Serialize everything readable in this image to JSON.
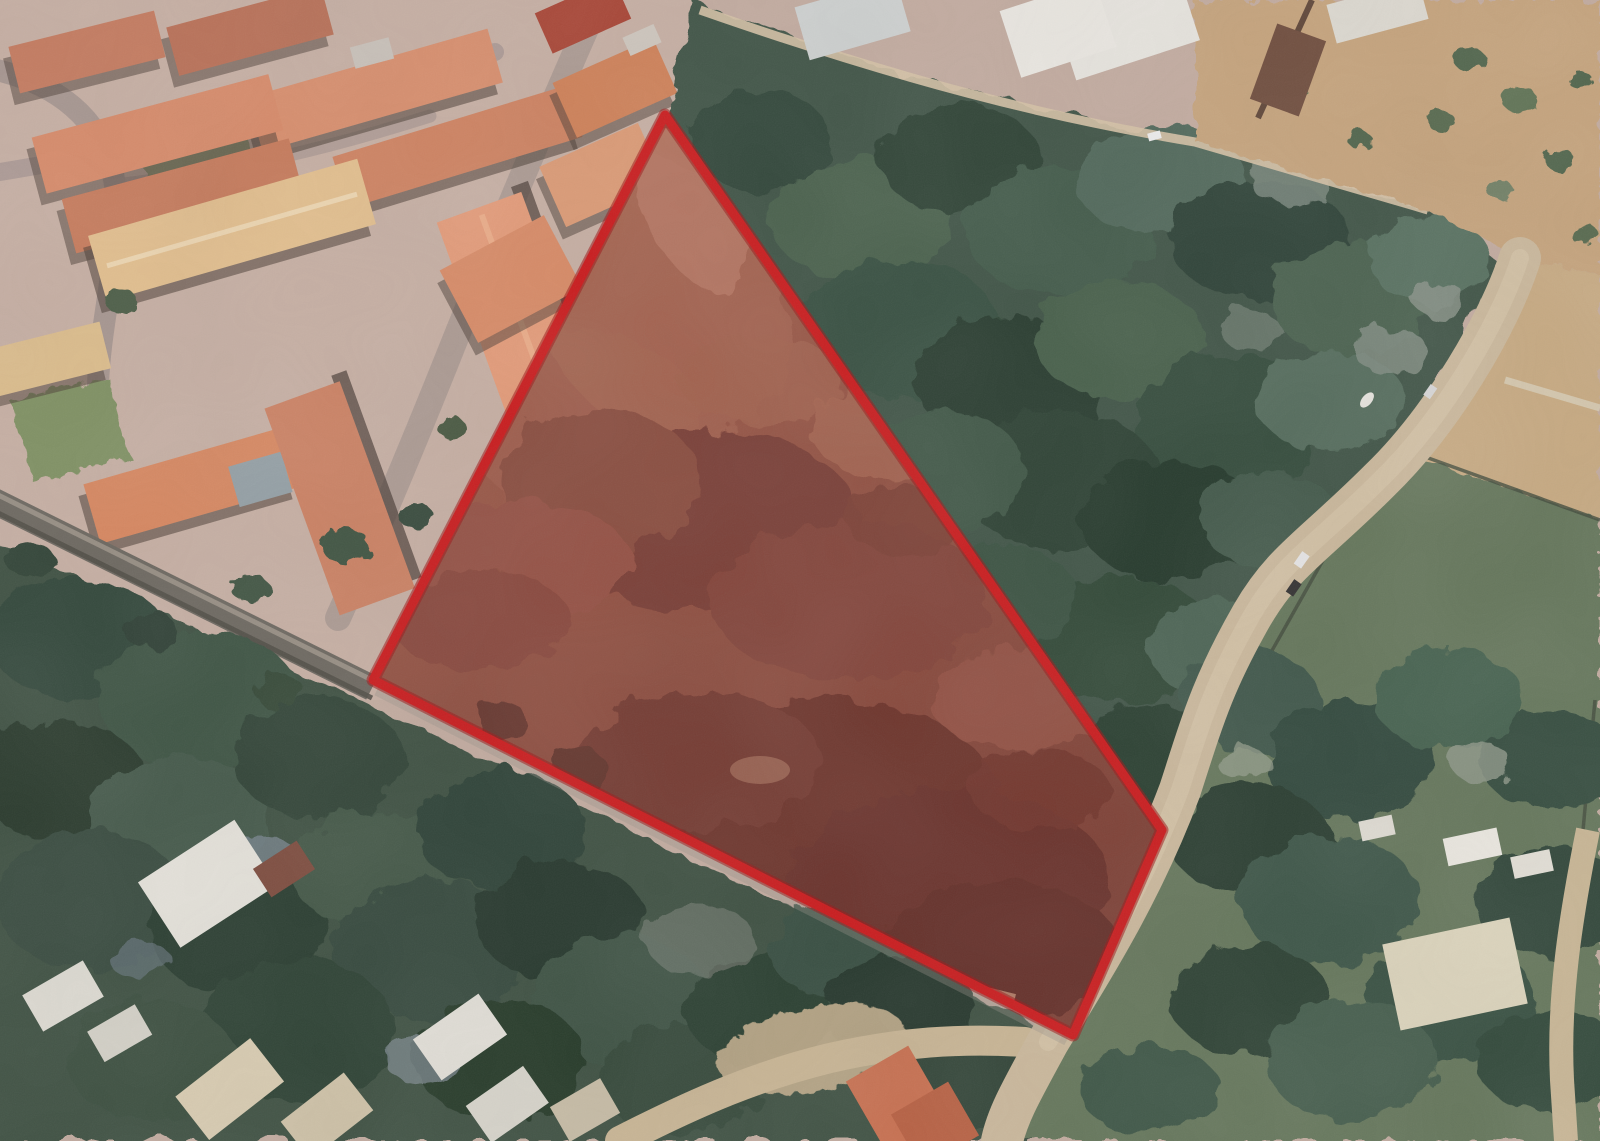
{
  "meta": {
    "view": "satellite-aerial-imagery",
    "visible_text": "none",
    "description": "Aerial photo with a red-outlined quadrilateral land parcel of cleared reddish earth; terracotta-roof housing blocks top-left, dense dark woodland top-right, tree-covered homes bottom-left, tan roads and green fields right and bottom"
  },
  "overlay": {
    "shape": "polygon",
    "purpose": "land-parcel-boundary",
    "outline_color": "#cb1719",
    "outline_inner_color": "#e02722",
    "outline_width_px": 9,
    "fill_color": "#c81e1e",
    "fill_opacity": 0.16,
    "vertices_px": [
      [
        665,
        115
      ],
      [
        1162,
        830
      ],
      [
        1073,
        1035
      ],
      [
        373,
        680
      ]
    ]
  },
  "scene": {
    "palette": {
      "ground": "#c3aca0",
      "ground_light": "#d2bdb0",
      "road_grey": "#a69690",
      "road_tan": "#cbb99c",
      "roof_orange": "#d3855f",
      "roof_tan": "#e4c08e",
      "roof_dark_red": "#a84232",
      "white_roof": "#e9e7e0",
      "woods_dark": "#3c5244",
      "woods_deep": "#26392c",
      "trees_bottom_left": "#33473a",
      "field_green": "#64765a",
      "dirt_top_right": "#c6a47c",
      "parcel_earth": "#8c5c49",
      "parcel_earth_dark": "#5e392e",
      "parcel_earth_light": "#a87a62"
    },
    "regions": [
      "residential-blocks-north-west",
      "woodland-north-east",
      "dirt-lot-north-east-corner",
      "outlined-dirt-parcel-center",
      "tree-covered-housing-south-west",
      "green-fields-south-east",
      "perimeter-roads"
    ]
  }
}
